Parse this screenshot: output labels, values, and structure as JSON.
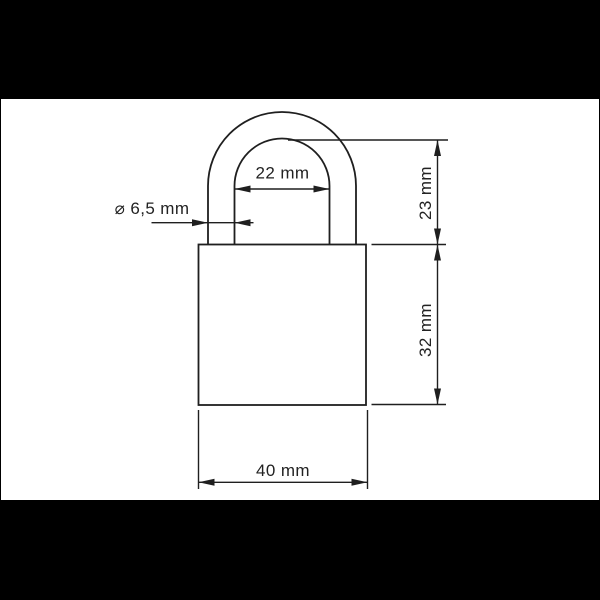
{
  "page": {
    "background_color": "#000000",
    "canvas_color": "#ffffff",
    "line_color": "#1f1f1f"
  },
  "drawing": {
    "dimensions": {
      "shackle_inner_width": "22 mm",
      "shackle_diameter": "⌀ 6,5 mm",
      "shackle_height": "23 mm",
      "body_height": "32 mm",
      "body_width": "40 mm"
    }
  }
}
